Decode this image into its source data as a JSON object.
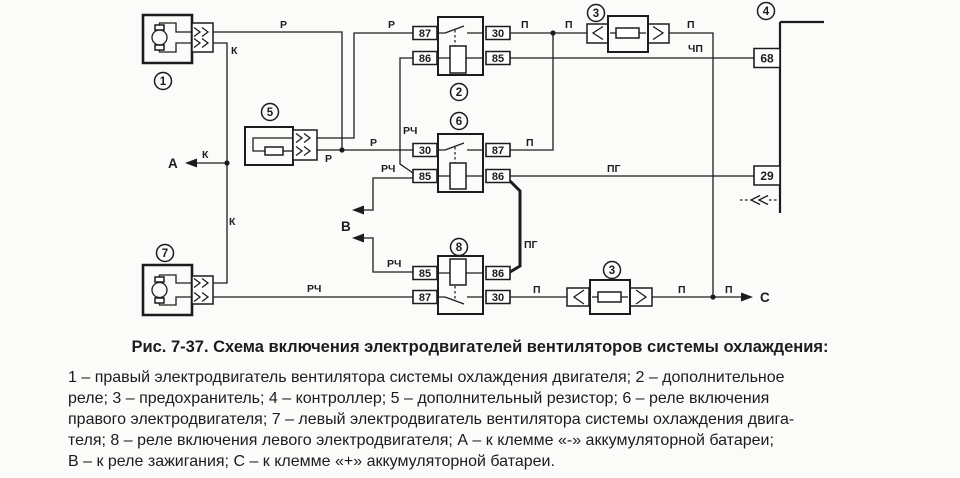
{
  "caption": "Рис. 7-37. Схема включения электродвигателей вентиляторов системы охлаждения:",
  "legend": {
    "l1": "1 – правый электродвигатель вентилятора системы охлаждения двигателя; 2 – дополнительное",
    "l2": "реле; 3 – предохранитель; 4 – контроллер; 5 – дополнительный резистор; 6 – реле включения",
    "l3": "правого электродвигателя; 7 – левый электродвигатель вентилятора системы охлаждения двига-",
    "l4": "теля; 8 – реле включения левого электродвигателя; А – к клемме «-» аккумуляторной батареи;",
    "l5": "В – к реле зажигания; С – к клемме «+» аккумуляторной батареи."
  },
  "callouts": {
    "c1": "1",
    "c2": "2",
    "c3a": "3",
    "c4": "4",
    "c5": "5",
    "c6": "6",
    "c7": "7",
    "c8": "8",
    "c3b": "3"
  },
  "terminals": {
    "r2_87": "87",
    "r2_86": "86",
    "r2_30": "30",
    "r2_85": "85",
    "r6_30": "30",
    "r6_85": "85",
    "r6_87": "87",
    "r6_86": "86",
    "r8_85": "85",
    "r8_87": "87",
    "r8_86": "86",
    "r8_30": "30"
  },
  "controller": {
    "pin68": "68",
    "pin29": "29"
  },
  "wire_labels": {
    "p1": "Р",
    "p2": "Р",
    "p3": "Р",
    "p4": "Р",
    "k1": "К",
    "k2": "К",
    "k3": "К",
    "pi1": "П",
    "pi2": "П",
    "pi3": "П",
    "pi4": "П",
    "pi5": "П",
    "pi6": "П",
    "pi7": "П",
    "chp": "ЧП",
    "pg1": "ПГ",
    "pg2": "ПГ",
    "rch1": "РЧ",
    "rch2": "РЧ",
    "rch3": "РЧ",
    "rch4": "РЧ"
  },
  "points": {
    "a": "А",
    "b": "В",
    "c": "С"
  },
  "colors": {
    "ink": "#1c1c1c",
    "background": "#fbfbf9"
  }
}
